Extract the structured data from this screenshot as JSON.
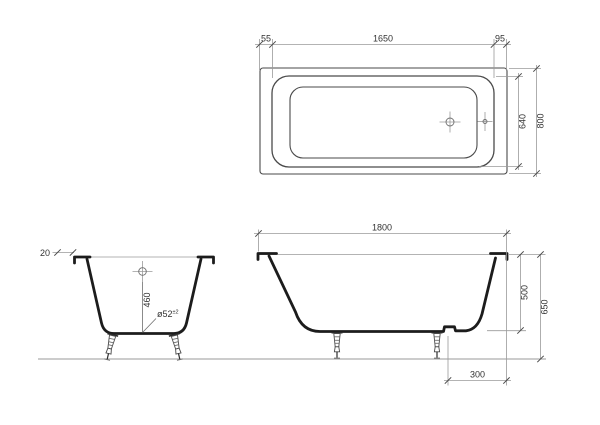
{
  "colors": {
    "bg": "#ffffff",
    "thick": "#1c1c1c",
    "line": "#4a4a4a",
    "mid": "#6e6e6e",
    "dim": "#9a9a9a",
    "text": "#333333"
  },
  "views": {
    "plan": {
      "name": "top view",
      "dims": {
        "left_offset": "55",
        "basin_length": "1650",
        "right_offset": "95",
        "basin_width": "640",
        "overall_width": "800"
      }
    },
    "end_section": {
      "name": "end section view",
      "dims": {
        "rim_lip": "20",
        "drain_to_rim": "460"
      },
      "drain_label": {
        "text": "ø52",
        "tolerance": "±2"
      }
    },
    "side_section": {
      "name": "side section view",
      "dims": {
        "overall_length": "1800",
        "basin_depth": "500",
        "overall_height": "650",
        "drain_offset": "300"
      }
    }
  }
}
